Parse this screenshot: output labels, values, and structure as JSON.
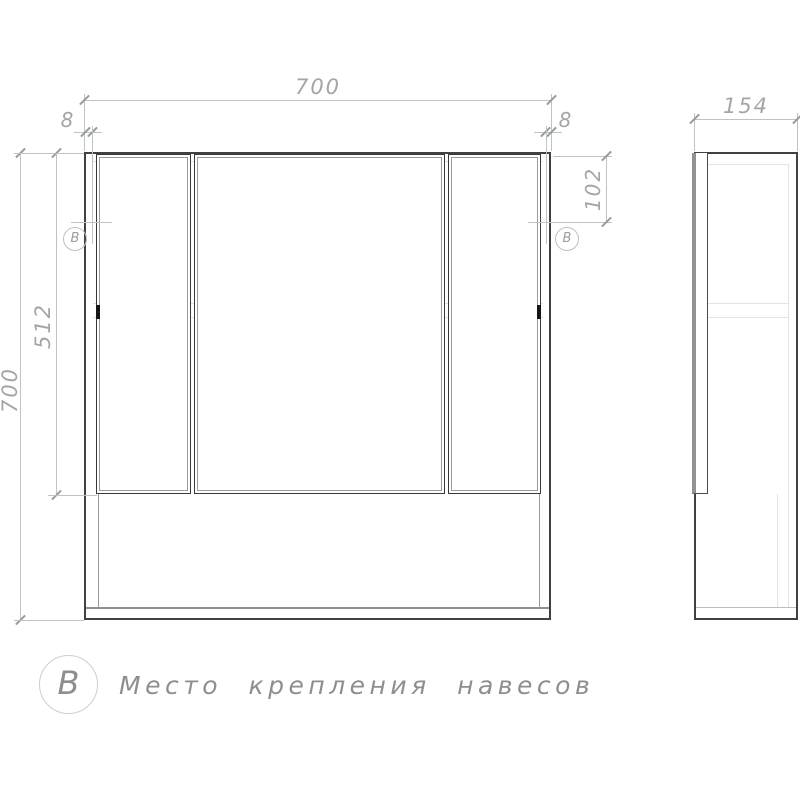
{
  "drawing": {
    "title": "Mirror cabinet technical drawing",
    "views": {
      "front": {
        "dims": {
          "overall_width": "700",
          "overall_height": "700",
          "door_height": "512",
          "hinge_inset_left": "8",
          "hinge_inset_right": "8",
          "hinge_top_offset": "102"
        },
        "hinge_marker": "B"
      },
      "side": {
        "dims": {
          "depth": "154"
        }
      }
    },
    "legend": {
      "marker": "B",
      "caption": "Место крепления навесов"
    },
    "colors": {
      "outline": "#414141",
      "dimension_line": "#bfc3c2",
      "dimension_text": "#a4a6a5",
      "faint_line": "#e3e3e3",
      "legend_text": "#8e8e8e"
    }
  }
}
